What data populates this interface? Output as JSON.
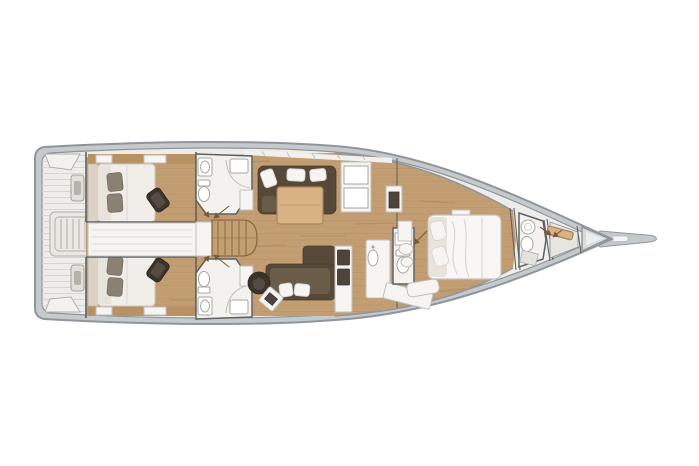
{
  "title": "Sailing yacht interior layout — top-down floor plan, bow pointing right",
  "canvas": {
    "width": 699,
    "height": 466
  },
  "colors": {
    "background": "#ffffff",
    "hull_outline": "#8f959b",
    "gunwale_fill": "#c7cacd",
    "deck_fill": "#eeedea",
    "deck_plank_line": "#dbd8d2",
    "wood_floor": "#c39e73",
    "wood_plank_line": "#9c7a50",
    "wood_dark_band": "#b99264",
    "wall_line": "#5f6367",
    "furniture_white": "#f6f5f3",
    "furniture_outline": "#c2bfb9",
    "bathroom_floor": "#f3f2ef",
    "fixture_outline": "#a8a5a0",
    "mattress": "#f1eee9",
    "mattress_outline": "#ccc8c1",
    "pillow_dark": "#8a8174",
    "sofa_dark": "#574939",
    "sofa_light": "#6b5b49",
    "pouf_dark": "#3c342c",
    "table_wood": "#d9b284",
    "table_outline": "#a8855a",
    "stairs_wood": "#c49f72",
    "stairs_outline": "#8a6a45",
    "appliance_dark": "#4e443a",
    "arrow": "#7a5a36",
    "bow_fill": "#d9dadb",
    "bowsprit_fill": "#c6c9cc"
  },
  "scene": {
    "type": "yacht-floor-plan",
    "orientation": "bow-right-stern-left",
    "rooms": [
      {
        "id": "stern-cockpit",
        "label": "Aft cockpit with corner seats, winches and swim-ladder box"
      },
      {
        "id": "aft-cabin-top",
        "label": "Aft double cabin (top) with bed, dark pillows and pouf"
      },
      {
        "id": "aft-cabin-bottom",
        "label": "Aft double cabin (bottom) with bed, dark pillows and pouf"
      },
      {
        "id": "aft-head-top",
        "label": "Aft bathroom (top) with toilet, sink and shower"
      },
      {
        "id": "aft-head-bottom",
        "label": "Aft bathroom (bottom) with toilet, sink and shower"
      },
      {
        "id": "engine-corridor",
        "label": "Central engine-hatch corridor between aft cabins"
      },
      {
        "id": "companionway",
        "label": "Companionway stairs"
      },
      {
        "id": "salon",
        "label": "Salon: dark L-sofa with white cushions, wood table, lounge chaise, round armchair, side table"
      },
      {
        "id": "galley",
        "label": "Galley column with appliances, sink counter and angled counter"
      },
      {
        "id": "mid-head",
        "label": "Mid bathroom / day head with toilet"
      },
      {
        "id": "master-cabin",
        "label": "Forward master cabin with island double bed, vanity stools and bench"
      },
      {
        "id": "forward-head",
        "label": "Forward bathroom with round sink, toilet and shower"
      },
      {
        "id": "sail-locker",
        "label": "Bow sail locker with shelf"
      },
      {
        "id": "bow",
        "label": "Bow tip and bowsprit"
      }
    ]
  }
}
